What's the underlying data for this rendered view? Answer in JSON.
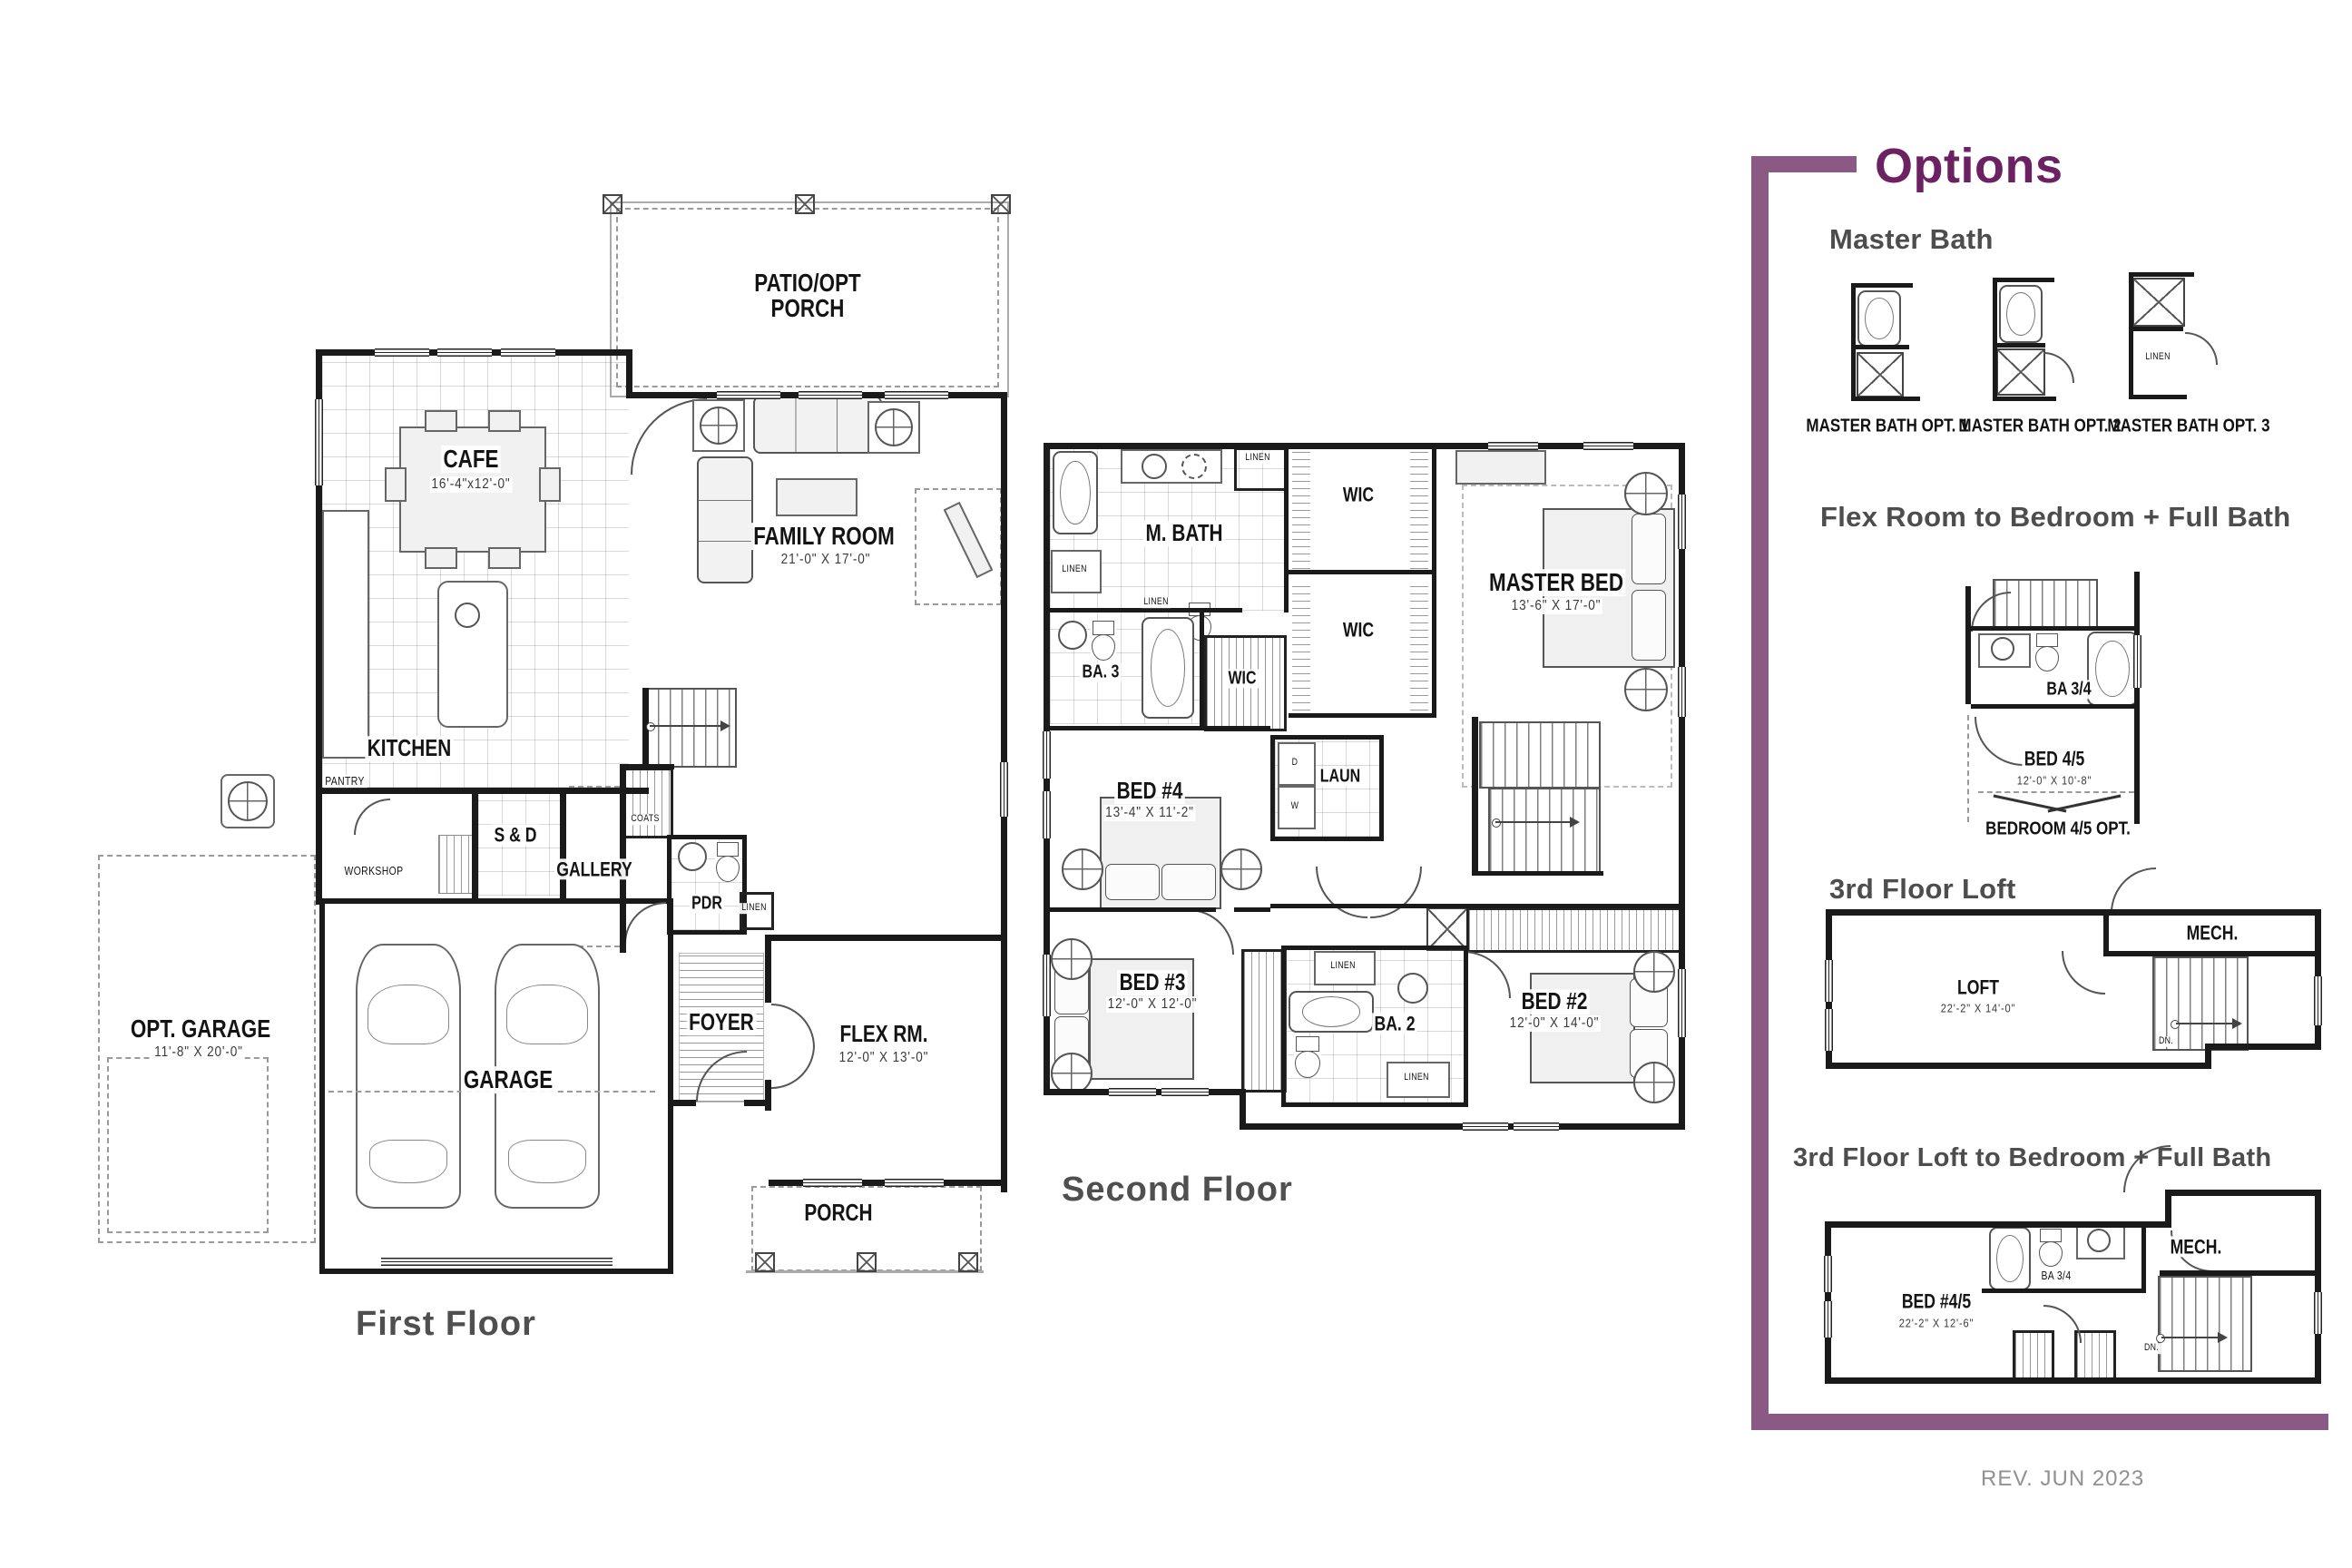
{
  "colors": {
    "accent_bar": "#8a5a84",
    "accent_text": "#6b2162",
    "heading_gray": "#4d4d4d",
    "rev_gray": "#919191"
  },
  "first_floor": {
    "title": "First Floor",
    "rooms": {
      "patio_l1": "PATIO/OPT",
      "patio_l2": "PORCH",
      "cafe": "CAFE",
      "cafe_dims": "16'-4\"x12'-0\"",
      "family": "FAMILY ROOM",
      "family_dims": "21'-0\" X 17'-0\"",
      "kitchen": "KITCHEN",
      "pantry": "PANTRY",
      "workshop": "WORKSHOP",
      "sd": "S & D",
      "gallery": "GALLERY",
      "coats": "COATS",
      "pdr": "PDR",
      "linen": "LINEN",
      "foyer": "FOYER",
      "flex": "FLEX RM.",
      "flex_dims": "12'-0\" X 13'-0\"",
      "garage": "GARAGE",
      "opt_garage": "OPT. GARAGE",
      "opt_garage_dims": "11'-8\" X 20'-0\"",
      "porch": "PORCH"
    }
  },
  "second_floor": {
    "title": "Second Floor",
    "rooms": {
      "m_bath": "M. BATH",
      "linen": "LINEN",
      "wic": "WIC",
      "master_bed": "MASTER BED",
      "master_bed_dims": "13'-6\" X 17'-0\"",
      "ba3": "BA. 3",
      "bed4": "BED #4",
      "bed4_dims": "13'-4\" X 11'-2\"",
      "laun": "LAUN",
      "d": "D",
      "w": "W",
      "bed3": "BED #3",
      "bed3_dims": "12'-0\" X 12'-0\"",
      "ba2": "BA. 2",
      "bed2": "BED #2",
      "bed2_dims": "12'-0\" X 14'-0\""
    }
  },
  "options": {
    "title": "Options",
    "master_bath": {
      "heading": "Master Bath",
      "opt1": "MASTER BATH OPT. 1",
      "opt2": "MASTER BATH OPT. 2",
      "opt3": "MASTER BATH OPT. 3",
      "linen": "LINEN"
    },
    "flex_opt": {
      "heading": "Flex Room to Bedroom + Full Bath",
      "ba": "BA 3/4",
      "bed": "BED 4/5",
      "bed_dims": "12'-0\" X 10'-8\"",
      "caption": "BEDROOM 4/5 OPT."
    },
    "loft": {
      "heading": "3rd Floor Loft",
      "mech": "MECH.",
      "name": "LOFT",
      "dims": "22'-2\" X 14'-0\"",
      "dn": "DN."
    },
    "loft_bed": {
      "heading": "3rd Floor Loft to Bedroom + Full Bath",
      "mech": "MECH.",
      "bed": "BED #4/5",
      "bed_dims": "22'-2\" X 12'-6\"",
      "ba": "BA 3/4",
      "dn": "DN."
    },
    "rev": "REV. JUN 2023"
  }
}
